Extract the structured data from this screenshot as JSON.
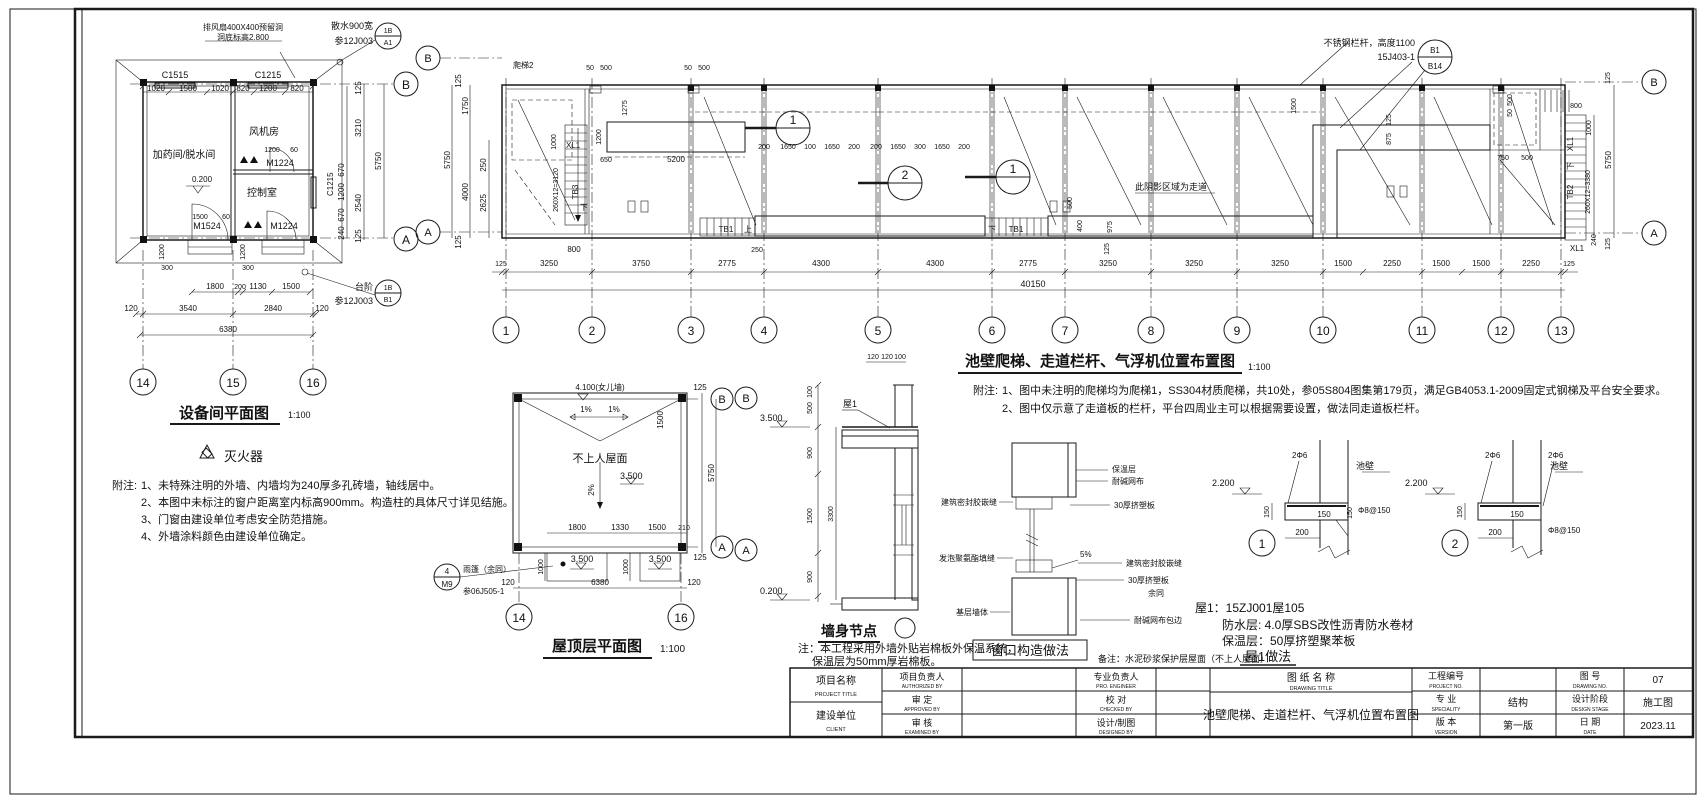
{
  "equip": {
    "title": "设备间平面图",
    "scale": "1:100",
    "rooms": [
      "加药间/脱水间",
      "风机房",
      "控制室"
    ],
    "windows": [
      "C1515",
      "C1215",
      "C1215"
    ],
    "doors": [
      "M1224",
      "M1524",
      "M1224"
    ],
    "level": "0.200",
    "co_fan": [
      "排风扇400X400预留洞",
      "洞底标高2.800"
    ],
    "co_ss": [
      "散水900宽",
      "参12J003"
    ],
    "bub_ss": [
      "1B",
      "A1"
    ],
    "co_tj": [
      "台阶",
      "参12J003"
    ],
    "bub_tj": [
      "1B",
      "B1"
    ],
    "grids": [
      "14",
      "15",
      "16"
    ],
    "letters": [
      "B",
      "A"
    ],
    "legend": "灭火器",
    "dims": [
      "1020",
      "1500",
      "1020",
      "820",
      "1200",
      "820",
      "1200",
      "60",
      "1500",
      "60",
      "670",
      "1200",
      "670",
      "240",
      "125",
      "3210",
      "2540",
      "125",
      "5750",
      "1200",
      "300",
      "1200",
      "300",
      "1800",
      "200",
      "1130",
      "1500",
      "120",
      "3540",
      "2840",
      "120",
      "6380"
    ],
    "note_label": "附注:",
    "notes": [
      "1、未特殊注明的外墙、内墙均为240厚多孔砖墙，轴线居中。",
      "2、本图中未标注的窗户距离室内标高900mm。构造柱的具体尺寸详见结施。",
      "3、门窗由建设单位考虑安全防范措施。",
      "4、外墙涂料颜色由建设单位确定。"
    ]
  },
  "plan": {
    "title": "池壁爬梯、走道栏杆、气浮机位置布置图",
    "scale": "1:100",
    "grids": [
      "1",
      "2",
      "3",
      "4",
      "5",
      "6",
      "7",
      "8",
      "9",
      "10",
      "11",
      "12",
      "13"
    ],
    "letters": [
      "B",
      "A"
    ],
    "dims_bot": [
      "125",
      "3250",
      "3750",
      "2775",
      "4300",
      "4300",
      "2775",
      "3250",
      "3250",
      "3250",
      "1500",
      "2250",
      "1500",
      "1500",
      "2250",
      "125"
    ],
    "total": "40150",
    "dims_left": [
      "125",
      "1750",
      "250",
      "2625",
      "4000",
      "5750",
      "125"
    ],
    "dims_cell": [
      "200",
      "1650",
      "100",
      "1650",
      "200",
      "200",
      "1650",
      "300",
      "1650",
      "200"
    ],
    "dims_top": [
      "50",
      "500",
      "50",
      "500",
      "1275",
      "1200",
      "650",
      "5200",
      "1000"
    ],
    "dims_walk": [
      "500",
      "400",
      "975",
      "125",
      "250"
    ],
    "dims_r1": [
      "1500",
      "125",
      "875",
      "750",
      "500",
      "500",
      "50"
    ],
    "dims_right": [
      "125",
      "800",
      "1000",
      "5750",
      "260X12=3380",
      "240",
      "125"
    ],
    "stair": [
      "爬梯2",
      "XL1",
      "下",
      "TB3",
      "260X12=3120",
      "800",
      "TB1",
      "上",
      "下",
      "TB1",
      "TB2",
      "下",
      "XL1",
      "XL1"
    ],
    "walk_label": "此阴影区域为走道",
    "co_rail": [
      "不锈钢栏杆，高度1100",
      "15J403-1"
    ],
    "bub_rail": [
      "B1",
      "B14"
    ],
    "markers": [
      "1",
      "2",
      "1"
    ],
    "note_label": "附注:",
    "notes": [
      "1、图中未注明的爬梯均为爬梯1，SS304材质爬梯，共10处，参05S804图集第179页，满足GB4053.1-2009固定式钢梯及平台安全要求。",
      "2、图中仅示意了走道板的栏杆，平台四周业主可以根据需要设置，做法同走道板栏杆。"
    ]
  },
  "roof": {
    "title": "屋顶层平面图",
    "scale": "1:100",
    "grids": [
      "14",
      "16"
    ],
    "letters": [
      "B",
      "A"
    ],
    "labels": [
      "4.100(女儿墙)",
      "1%",
      "1%",
      "不上人屋面",
      "2%",
      "3.500",
      "3.500",
      "3.500"
    ],
    "dims": [
      "1500",
      "1800",
      "1330",
      "1500",
      "210",
      "1000",
      "1000",
      "120",
      "6380",
      "120",
      "125",
      "5750",
      "125"
    ],
    "co": [
      "雨篷（余同）",
      "参06J505-1"
    ],
    "bub": [
      "4",
      "M9"
    ]
  },
  "wall": {
    "title": "墙身节点",
    "letters": [
      "B",
      "A"
    ],
    "elev": [
      "3.500",
      "0.200"
    ],
    "dims": [
      "100",
      "500",
      "900",
      "1500",
      "900",
      "3300",
      "120",
      "120",
      "100"
    ],
    "roof1": "屋1",
    "notes": [
      "注：本工程采用外墙外贴岩棉板外保温系统，",
      "保温层为50mm厚岩棉板。"
    ]
  },
  "win": {
    "title": "窗口构造做法",
    "left": [
      "建筑密封胶嵌缝",
      "发泡聚氨酯填缝",
      "基层墙体"
    ],
    "right": [
      "保温层",
      "耐碱网布",
      "30厚挤塑板",
      "5%",
      "建筑密封胶嵌缝",
      "30厚挤塑板",
      "余同",
      "耐碱网布包边"
    ]
  },
  "det": {
    "d1": {
      "num": "1",
      "labels": [
        "2.200",
        "2Φ6",
        "池壁",
        "150",
        "150",
        "150",
        "Φ8@150",
        "200"
      ]
    },
    "d2": {
      "num": "2",
      "labels": [
        "2.200",
        "2Φ6",
        "2Φ6",
        "池壁",
        "150",
        "150",
        "Φ8@150",
        "200"
      ]
    }
  },
  "roof1": {
    "lines": [
      "屋1：15ZJ001屋105",
      "防水层: 4.0厚SBS改性沥青防水卷材",
      "保温层：50厚挤塑聚苯板"
    ],
    "caption": "屋1做法",
    "remark": "备注：水泥砂浆保护层屋面（不上人屋面）"
  },
  "tb": {
    "project_label": "项目名称",
    "project_en": "PROJECT TITLE",
    "client_label": "建设单位",
    "client_en": "CLIENT",
    "p1": "项目负责人",
    "p1en": "AUTHORIZED BY",
    "p2": "审  定",
    "p2en": "APPROVED BY",
    "p3": "审  核",
    "p3en": "EXAMINED BY",
    "p4": "专业负责人",
    "p4en": "PRO. ENGINEER",
    "p5": "校  对",
    "p5en": "CHECKED BY",
    "p6": "设计/制图",
    "p6en": "DESIGNED BY",
    "dt_label": "图 纸 名 称",
    "dt_en": "DRAWING TITLE",
    "dt_value": "池壁爬梯、走道栏杆、气浮机位置布置图",
    "no_label": "工程编号",
    "no_en": "PROJECT NO.",
    "no_value": "",
    "dn_label": "图  号",
    "dn_en": "DRAWING NO.",
    "dn_value": "07",
    "sp_label": "专  业",
    "sp_en": "SPECIALITY",
    "sp_value": "结构",
    "st_label": "设计阶段",
    "st_en": "DESIGN STAGE",
    "st_value": "施工图",
    "ver_label": "版  本",
    "ver_en": "VERSION",
    "ver_value": "第一版",
    "date_label": "日  期",
    "date_en": "DATE",
    "date_value": "2023.11"
  }
}
